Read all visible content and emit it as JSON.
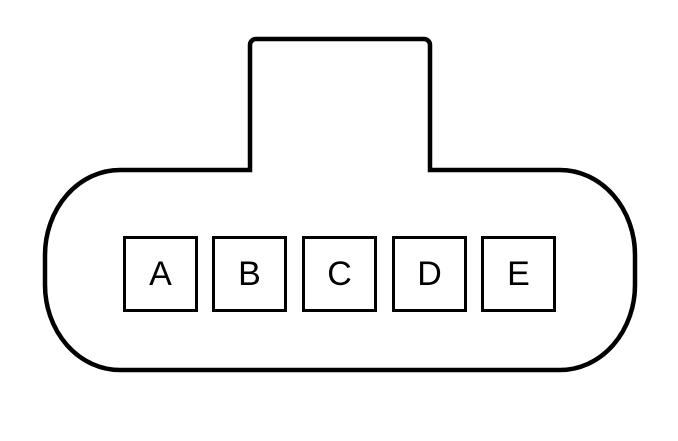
{
  "connector": {
    "pins": [
      "A",
      "B",
      "C",
      "D",
      "E"
    ],
    "line_color": "#000000",
    "background_color": "#ffffff"
  }
}
